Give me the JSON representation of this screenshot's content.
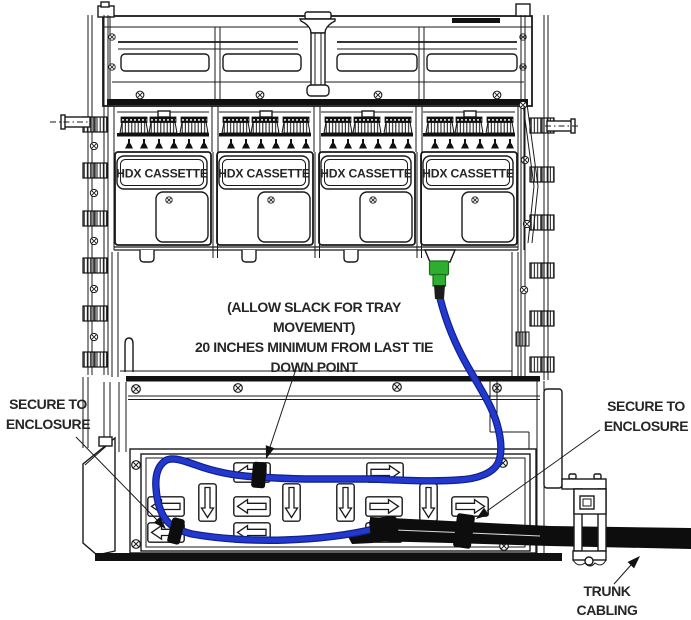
{
  "cassettes": [
    {
      "label": "HDX CASSETTE"
    },
    {
      "label": "HDX CASSETTE"
    },
    {
      "label": "HDX CASSETTE"
    },
    {
      "label": "HDX CASSETTE"
    }
  ],
  "annotations": {
    "slack_note": {
      "lines": [
        "(ALLOW SLACK FOR TRAY",
        "MOVEMENT)",
        "20 INCHES MINIMUM FROM LAST TIE",
        "DOWN POINT"
      ]
    },
    "secure_left": {
      "lines": [
        "SECURE TO",
        "ENCLOSURE"
      ]
    },
    "secure_right": {
      "lines": [
        "SECURE TO",
        "ENCLOSURE"
      ]
    },
    "trunk_label": {
      "lines": [
        "TRUNK",
        "CABLING"
      ]
    }
  },
  "colors": {
    "cable_blue": "#2239d0",
    "cable_blue_dark": "#141f8a",
    "connector_green": "#2eae30",
    "connector_green_dark": "#156f17",
    "cable_black": "#0d0d0d",
    "line": "#1a1a1a",
    "text": "#262626"
  }
}
